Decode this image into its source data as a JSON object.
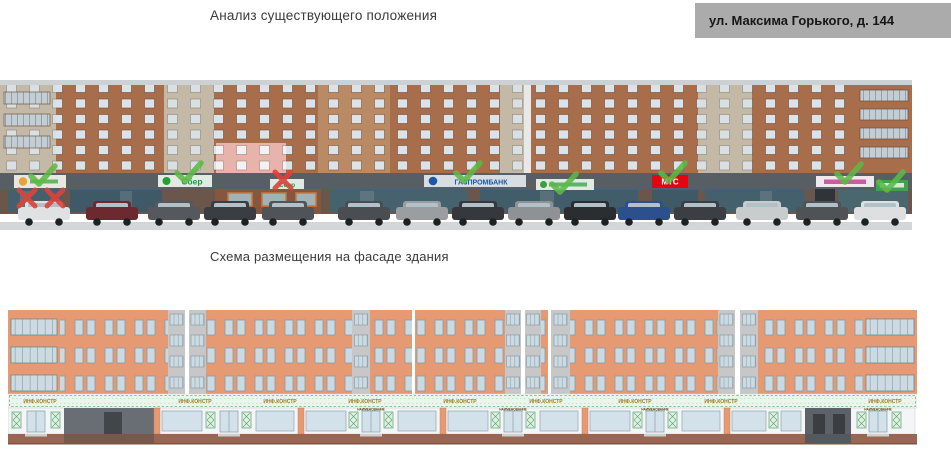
{
  "page": {
    "title": "Анализ существующего положения",
    "address": "ул. Максима Горького, д. 144",
    "scheme_title": "Схема размещения на фасаде здания"
  },
  "photo": {
    "signs": {
      "sber": "Сбер",
      "sber_crossed": "Сбер",
      "gazprombank": "ГАЗПРОМБАНК",
      "mts": "МТС"
    },
    "marks": {
      "approved_count": 7,
      "rejected_count": 3,
      "approve_check_icon": "✓",
      "reject_cross_icon": "✗"
    }
  },
  "elevation": {
    "sign_label": "ИНФ.КОНСТР",
    "door_label": "НАИМЕНОВАНИЕ"
  },
  "colors": {
    "address_box_bg": "#ababab",
    "approve_green": "#5cb847",
    "reject_red": "#dd4339",
    "photo_brick": "#a86e4b",
    "photo_fascia": "#575e64",
    "elevation_wall": "#e59a74",
    "sign_band_fill": "#eaf6ec",
    "sber_green": "#21a038",
    "gazprom_blue": "#1d57a6",
    "mts_red": "#e30611",
    "base_brown": "#9b6651"
  }
}
